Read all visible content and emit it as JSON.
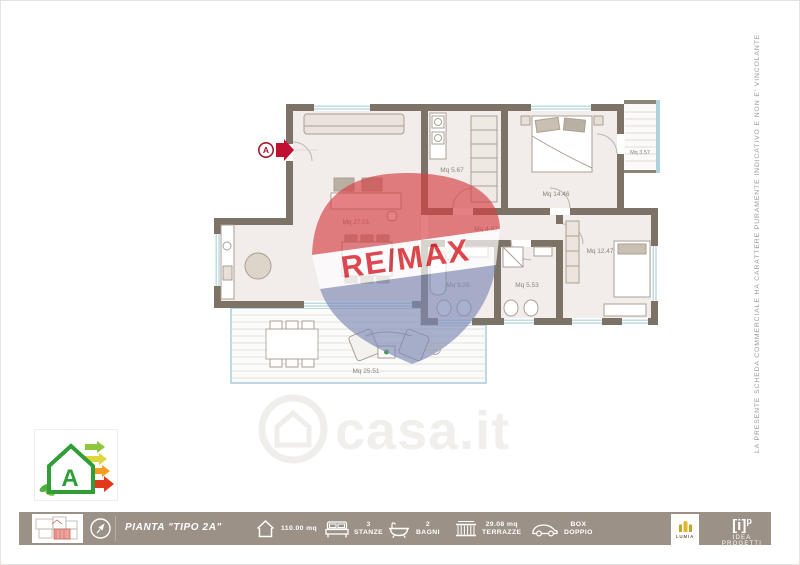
{
  "plan": {
    "entrance_label": "A",
    "rooms": [
      {
        "name": "soggiorno",
        "label": "Mq 27.01"
      },
      {
        "name": "lavanderia",
        "label": "Mq 5.67"
      },
      {
        "name": "camera-matrimoniale",
        "label": "Mq 14.46"
      },
      {
        "name": "disimpegno",
        "label": "Mq 4.97"
      },
      {
        "name": "balcone",
        "label": "Mq 3.57"
      },
      {
        "name": "camera",
        "label": "Mq 12.47"
      },
      {
        "name": "bagno-1",
        "label": "Mq 9.26"
      },
      {
        "name": "bagno-2",
        "label": "Mq 5.53"
      },
      {
        "name": "terrazzo",
        "label": "Mq 25.51"
      }
    ]
  },
  "watermarks": {
    "remax": {
      "re": "RE",
      "slash": "/",
      "max": "MAX",
      "registered": "R"
    },
    "casa": {
      "text": "casa.it"
    }
  },
  "energy": {
    "class_letter": "A"
  },
  "disclaimer": "LA PRESENTE SCHEDA COMMERCIALE HA CARATTERE PURAMENTE INDICATIVO E NON E' VINCOLANTE",
  "footer": {
    "plan_title": "PIANTA \"TIPO 2A\"",
    "stats": [
      {
        "icon": "house-icon",
        "value": "110.00 mq",
        "label": ""
      },
      {
        "icon": "bed-icon",
        "value": "3",
        "label": "STANZE"
      },
      {
        "icon": "bath-icon",
        "value": "2",
        "label": "BAGNI"
      },
      {
        "icon": "terrace-icon",
        "value": "29.08 mq",
        "label": "TERRAZZE"
      },
      {
        "icon": "car-icon",
        "value": "BOX",
        "label": "DOPPIO"
      }
    ],
    "lumia": "LUMIA",
    "brand": {
      "bracket": "[i]",
      "sup": "p",
      "name": "IDEA PROGETTI"
    }
  },
  "colors": {
    "footer_bg": "#9b9187",
    "wall": "#7c7265",
    "floor": "#f2eceb",
    "window_blue": "#aed3dc",
    "terrace_border": "#a7ccd7",
    "remax_red": "#d8232a",
    "remax_blue": "#7e8ab5",
    "entrance_red": "#c00f2f",
    "energy_green": "#2f9e36",
    "lumia_gold": "#c9a227"
  }
}
